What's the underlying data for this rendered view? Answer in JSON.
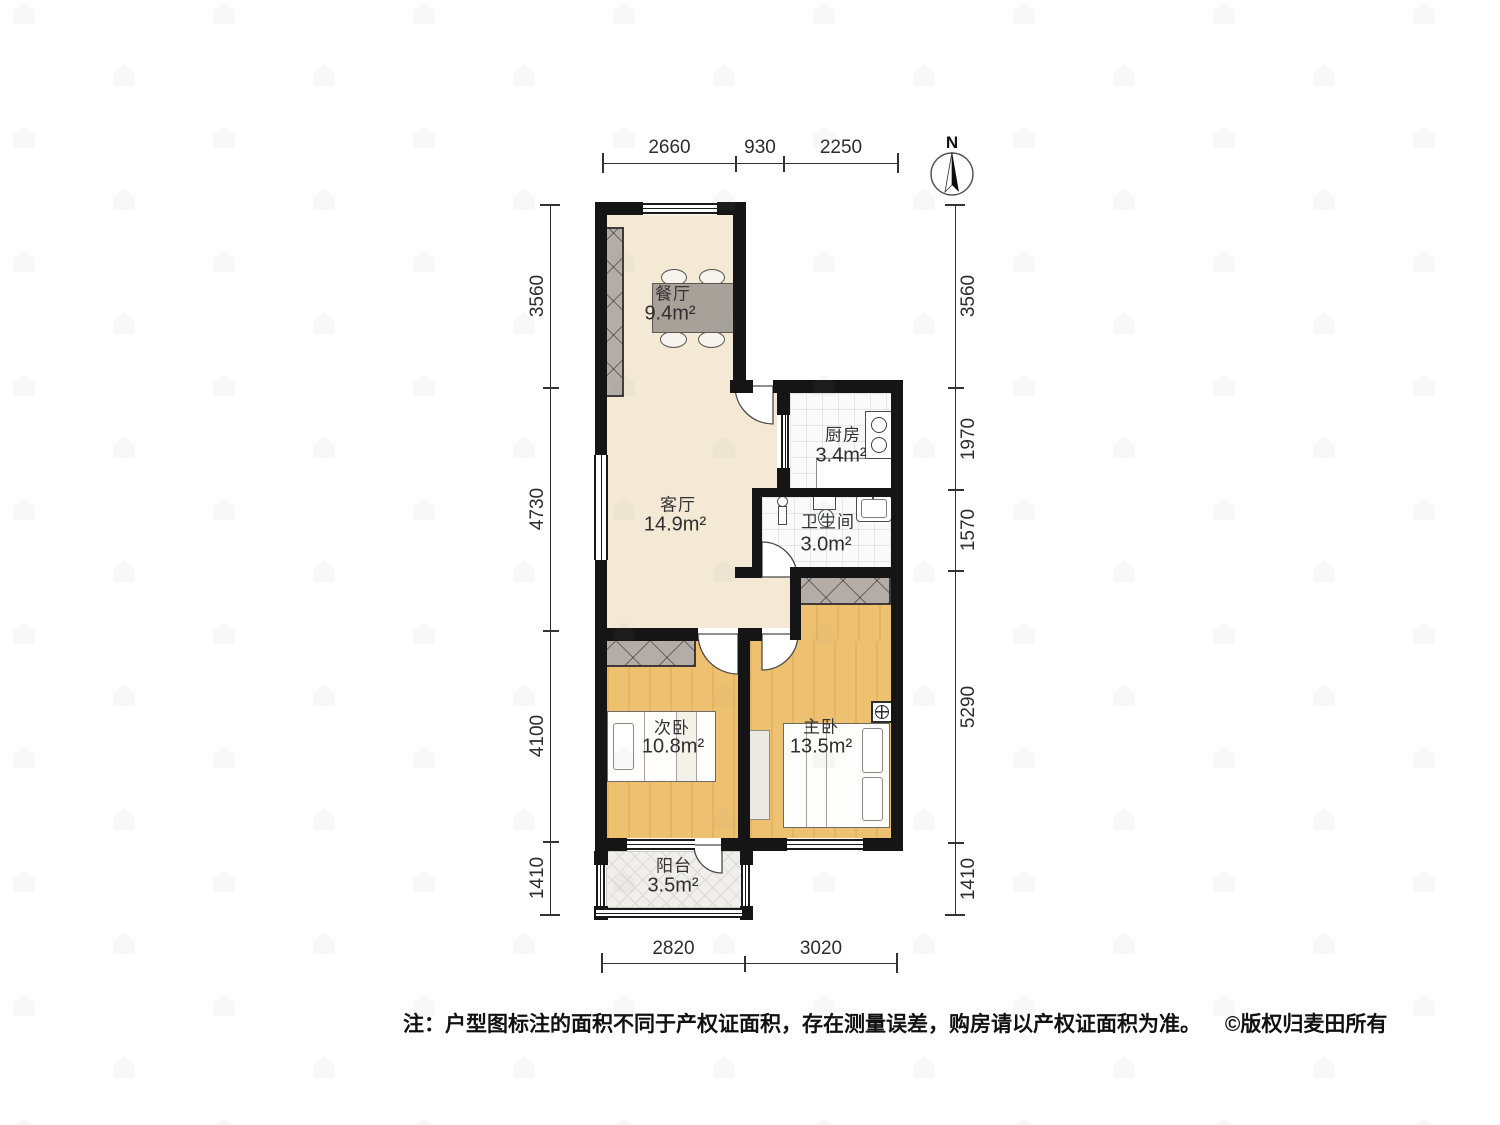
{
  "floorplan": {
    "title_note": {
      "text": "注：户型图标注的面积不同于产权证面积，存在测量误差，购房请以产权证面积为准。",
      "copyright": "©版权归麦田所有"
    },
    "compass": {
      "label": "N"
    },
    "rooms": [
      {
        "id": "dining",
        "name": "餐厅",
        "area": "9.4m²"
      },
      {
        "id": "kitchen",
        "name": "厨房",
        "area": "3.4m²"
      },
      {
        "id": "living",
        "name": "客厅",
        "area": "14.9m²"
      },
      {
        "id": "bathroom",
        "name": "卫生间",
        "area": "3.0m²"
      },
      {
        "id": "second_bedroom",
        "name": "次卧",
        "area": "10.8m²"
      },
      {
        "id": "master_bedroom",
        "name": "主卧",
        "area": "13.5m²"
      },
      {
        "id": "balcony",
        "name": "阳台",
        "area": "3.5m²"
      }
    ],
    "dimensions_mm": {
      "top": [
        "2660",
        "930",
        "2250"
      ],
      "bottom": [
        "2820",
        "3020"
      ],
      "left": [
        "3560",
        "4730",
        "4100",
        "1410"
      ],
      "right": [
        "3560",
        "1970",
        "1570",
        "5290",
        "1410"
      ]
    },
    "colors": {
      "wall": "#151515",
      "living_floor": "#f3e9d5",
      "bedroom_floor": "#eec170",
      "tile_floor": "#fafafa",
      "furniture_gray": "#a8a19a",
      "wardrobe_hatch": "#b4ada7"
    }
  }
}
